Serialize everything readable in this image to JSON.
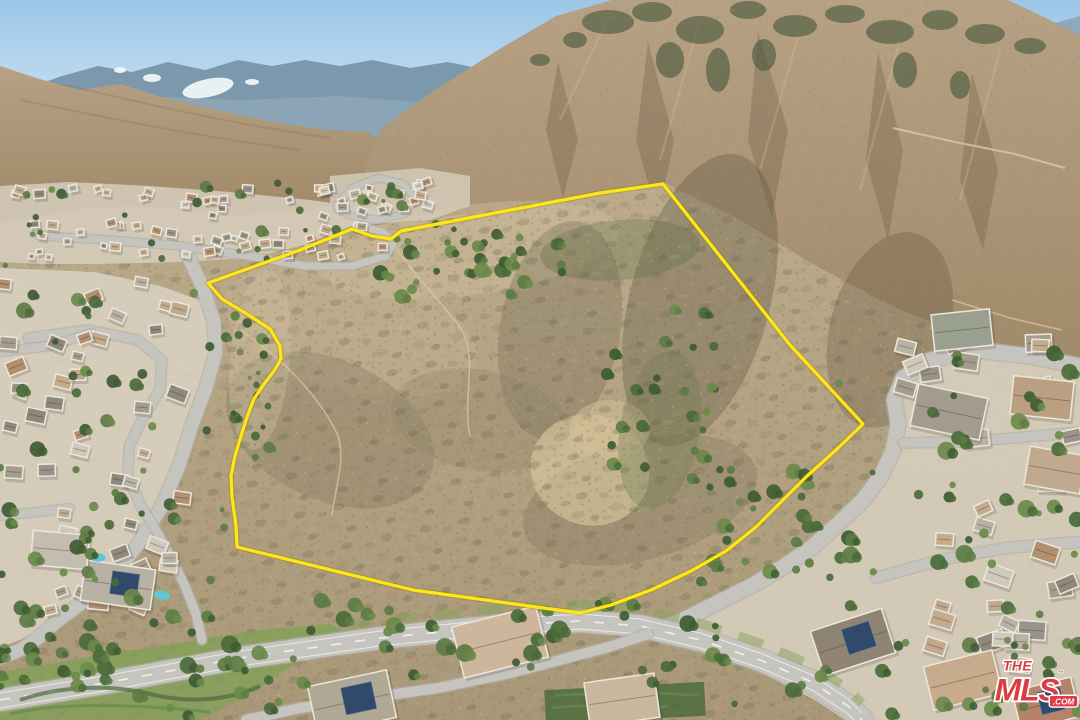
{
  "image": {
    "width": 1080,
    "height": 720,
    "kind": "aerial-drone-photo",
    "description": "Aerial real-estate photo of a vacant hillside land parcel outlined in yellow, surrounded by suburban neighborhoods at the foot of large scrub-covered mountains under a blue sky"
  },
  "watermark": {
    "line1": "THE",
    "line2": "MLS",
    "tm": "™",
    "suffix": ".COM",
    "red": "#dc3b41",
    "white": "#ffffff"
  },
  "palette": {
    "sky_top": "#9cc6e8",
    "sky_bottom": "#ddeef8",
    "far_ridge": "#7b98ad",
    "far_ridge2": "#91a9b8",
    "snow": "#f2f7fa",
    "mtn_light": "#b7a184",
    "mtn_dark": "#9e8867",
    "canyon": "#6e5a44",
    "forest": "#44573a",
    "streak": "#cfbd9b",
    "fg_light": "#bcab8b",
    "fg_dark": "#a99878",
    "speck_dark": "#6f6750",
    "speck_light": "#d9cdad",
    "olive": "#8b8468",
    "pale_base": "#d6cebd",
    "nb_base": "#d8d0c0",
    "road": "#c6c4be",
    "road_casing": "#b0ada6",
    "dash": "#f2f2ee",
    "house_wall": "#ece7db",
    "solar_panel": "#31496b",
    "pool": "#5ec8d8",
    "lawn": "#7fa055",
    "hedge": "#4c6b3d",
    "trail": "#d8c9a8",
    "outline_yellow": "#ffe714",
    "outline_casing": "#8a7a00"
  },
  "parcel_outline": {
    "stroke_width": 3.2,
    "points": [
      [
        663,
        184
      ],
      [
        790,
        345
      ],
      [
        863,
        424
      ],
      [
        836,
        450
      ],
      [
        806,
        477
      ],
      [
        779,
        504
      ],
      [
        756,
        527
      ],
      [
        726,
        551
      ],
      [
        691,
        571
      ],
      [
        651,
        590
      ],
      [
        611,
        605
      ],
      [
        580,
        613
      ],
      [
        413,
        590
      ],
      [
        237,
        547
      ],
      [
        236,
        526
      ],
      [
        232,
        497
      ],
      [
        231,
        476
      ],
      [
        235,
        456
      ],
      [
        241,
        436
      ],
      [
        247,
        417
      ],
      [
        254,
        399
      ],
      [
        264,
        384
      ],
      [
        274,
        371
      ],
      [
        281,
        359
      ],
      [
        280,
        346
      ],
      [
        270,
        329
      ],
      [
        247,
        314
      ],
      [
        222,
        299
      ],
      [
        208,
        283
      ],
      [
        300,
        250
      ],
      [
        352,
        229
      ],
      [
        372,
        236
      ],
      [
        391,
        239
      ],
      [
        401,
        231
      ],
      [
        500,
        212
      ],
      [
        600,
        193
      ]
    ]
  },
  "roads": [
    {
      "name": "left-canyon-road",
      "width": 13,
      "points": [
        [
          187,
          254
        ],
        [
          203,
          288
        ],
        [
          214,
          322
        ],
        [
          216,
          352
        ],
        [
          206,
          388
        ],
        [
          193,
          422
        ],
        [
          179,
          466
        ],
        [
          161,
          508
        ],
        [
          137,
          546
        ],
        [
          111,
          578
        ],
        [
          83,
          602
        ],
        [
          56,
          622
        ],
        [
          38,
          638
        ],
        [
          20,
          650
        ],
        [
          0,
          658
        ]
      ]
    },
    {
      "name": "left-inner-street",
      "width": 9,
      "points": [
        [
          28,
          338
        ],
        [
          88,
          330
        ],
        [
          138,
          340
        ],
        [
          162,
          360
        ],
        [
          160,
          390
        ],
        [
          143,
          418
        ],
        [
          129,
          446
        ],
        [
          128,
          476
        ],
        [
          141,
          506
        ],
        [
          157,
          532
        ],
        [
          171,
          558
        ],
        [
          185,
          586
        ],
        [
          196,
          614
        ],
        [
          202,
          640
        ]
      ]
    },
    {
      "name": "left-connector-upper",
      "width": 8,
      "points": [
        [
          0,
          352
        ],
        [
          50,
          346
        ],
        [
          92,
          333
        ]
      ]
    },
    {
      "name": "left-connector-lower",
      "width": 8,
      "points": [
        [
          0,
          516
        ],
        [
          38,
          512
        ],
        [
          70,
          508
        ]
      ]
    },
    {
      "name": "upper-valley-road",
      "width": 7,
      "points": [
        [
          40,
          236
        ],
        [
          110,
          240
        ],
        [
          180,
          246
        ],
        [
          248,
          256
        ],
        [
          305,
          266
        ],
        [
          352,
          266
        ],
        [
          386,
          256
        ],
        [
          394,
          242
        ],
        [
          382,
          232
        ],
        [
          362,
          226
        ]
      ]
    },
    {
      "name": "upper-loop-road",
      "width": 6,
      "points": [
        [
          336,
          206
        ],
        [
          352,
          188
        ],
        [
          378,
          178
        ],
        [
          404,
          184
        ],
        [
          416,
          200
        ],
        [
          404,
          214
        ],
        [
          378,
          220
        ],
        [
          352,
          216
        ],
        [
          338,
          210
        ],
        [
          336,
          206
        ]
      ]
    },
    {
      "name": "right-canyon-road",
      "width": 15,
      "points": [
        [
          1080,
          366
        ],
        [
          1030,
          356
        ],
        [
          976,
          350
        ],
        [
          930,
          360
        ],
        [
          903,
          378
        ],
        [
          894,
          400
        ],
        [
          898,
          424
        ],
        [
          893,
          450
        ],
        [
          881,
          476
        ],
        [
          863,
          500
        ],
        [
          839,
          523
        ],
        [
          811,
          548
        ],
        [
          783,
          567
        ],
        [
          753,
          585
        ],
        [
          719,
          602
        ],
        [
          683,
          620
        ],
        [
          658,
          630
        ]
      ]
    },
    {
      "name": "right-side-street",
      "width": 9,
      "points": [
        [
          903,
          443
        ],
        [
          958,
          442
        ],
        [
          1014,
          438
        ],
        [
          1080,
          432
        ]
      ]
    },
    {
      "name": "right-lower-street",
      "width": 10,
      "points": [
        [
          876,
          578
        ],
        [
          940,
          560
        ],
        [
          1005,
          548
        ],
        [
          1080,
          542
        ]
      ]
    },
    {
      "name": "boulevard",
      "width": 22,
      "dashed": true,
      "points": [
        [
          0,
          700
        ],
        [
          110,
          682
        ],
        [
          240,
          658
        ],
        [
          380,
          638
        ],
        [
          500,
          626
        ],
        [
          580,
          621
        ],
        [
          640,
          626
        ],
        [
          700,
          640
        ],
        [
          760,
          660
        ],
        [
          812,
          682
        ],
        [
          848,
          706
        ],
        [
          862,
          720
        ]
      ]
    },
    {
      "name": "bottom-street",
      "width": 10,
      "points": [
        [
          246,
          720
        ],
        [
          300,
          708
        ],
        [
          368,
          698
        ],
        [
          438,
          688
        ],
        [
          506,
          674
        ],
        [
          560,
          660
        ],
        [
          612,
          646
        ],
        [
          648,
          634
        ]
      ]
    }
  ],
  "roof_colors": [
    "#b8b2a5",
    "#a49d8f",
    "#c3ab8b",
    "#b28f6f",
    "#99948a",
    "#cfc9bb",
    "#8e897c",
    "#c0a98f"
  ],
  "tree_colors": [
    "#4a6b3a",
    "#5d7c44",
    "#3e5c33",
    "#6b8a4a"
  ],
  "house_regions": [
    {
      "name": "upper-valley",
      "x": 8,
      "y": 188,
      "w": 380,
      "h": 70,
      "count": 64,
      "min": 7,
      "max": 13,
      "angle": 20
    },
    {
      "name": "upper-valley-east",
      "x": 335,
      "y": 172,
      "w": 120,
      "h": 46,
      "count": 16,
      "min": 7,
      "max": 12,
      "angle": 20
    },
    {
      "name": "left-neighborhood",
      "x": 2,
      "y": 282,
      "w": 190,
      "h": 330,
      "count": 46,
      "min": 12,
      "max": 22,
      "angle": 25
    },
    {
      "name": "right-neighborhood",
      "x": 895,
      "y": 340,
      "w": 180,
      "h": 300,
      "count": 24,
      "min": 16,
      "max": 28,
      "angle": 25
    },
    {
      "name": "bottom-right-neighborhood",
      "x": 860,
      "y": 600,
      "w": 210,
      "h": 112,
      "count": 8,
      "min": 20,
      "max": 30,
      "angle": 20
    }
  ],
  "featured_houses": [
    {
      "x": 500,
      "y": 642,
      "w": 88,
      "h": 54,
      "a": -14,
      "roof": "#cdb69b",
      "solar": false,
      "pool": false
    },
    {
      "x": 352,
      "y": 702,
      "w": 82,
      "h": 50,
      "a": -12,
      "roof": "#b0a794",
      "solar": true,
      "pool": false
    },
    {
      "x": 622,
      "y": 700,
      "w": 72,
      "h": 46,
      "a": -8,
      "roof": "#c9b79d",
      "solar": false,
      "pool": false
    },
    {
      "x": 853,
      "y": 642,
      "w": 76,
      "h": 48,
      "a": -18,
      "roof": "#8f8373",
      "solar": true,
      "pool": false
    },
    {
      "x": 963,
      "y": 680,
      "w": 72,
      "h": 46,
      "a": -14,
      "roof": "#c8aa8d",
      "solar": false,
      "pool": false
    },
    {
      "x": 1046,
      "y": 704,
      "w": 62,
      "h": 42,
      "a": -14,
      "roof": "#b5826a",
      "solar": true,
      "pool": false
    },
    {
      "x": 949,
      "y": 412,
      "w": 72,
      "h": 44,
      "a": 12,
      "roof": "#a39b8d",
      "solar": false,
      "pool": false
    },
    {
      "x": 1042,
      "y": 398,
      "w": 62,
      "h": 40,
      "a": 6,
      "roof": "#ba9f82",
      "solar": false,
      "pool": false
    },
    {
      "x": 962,
      "y": 330,
      "w": 60,
      "h": 38,
      "a": -6,
      "roof": "#9aa08f",
      "solar": false,
      "pool": false
    },
    {
      "x": 1055,
      "y": 470,
      "w": 58,
      "h": 40,
      "a": 10,
      "roof": "#c0a98f",
      "solar": false,
      "pool": false
    },
    {
      "x": 118,
      "y": 585,
      "w": 72,
      "h": 42,
      "a": 8,
      "roof": "#b7b1a3",
      "solar": true,
      "pool": true
    },
    {
      "x": 60,
      "y": 550,
      "w": 58,
      "h": 36,
      "a": 5,
      "roof": "#c4bdaf",
      "solar": false,
      "pool": true
    }
  ],
  "tree_regions": [
    {
      "name": "upper-drainage",
      "x": 380,
      "y": 234,
      "w": 190,
      "h": 66,
      "count": 30,
      "min": 3,
      "max": 8
    },
    {
      "name": "parcel-east-drainage",
      "x": 596,
      "y": 300,
      "w": 120,
      "h": 170,
      "count": 24,
      "min": 3,
      "max": 7
    },
    {
      "name": "boundary-greenbelt",
      "x": 690,
      "y": 468,
      "w": 190,
      "h": 120,
      "count": 30,
      "min": 3,
      "max": 8
    },
    {
      "name": "boulevard-trees",
      "x": 0,
      "y": 596,
      "w": 720,
      "h": 95,
      "count": 48,
      "min": 3,
      "max": 9
    },
    {
      "name": "left-neighborhood-trees",
      "x": 0,
      "y": 286,
      "w": 215,
      "h": 340,
      "count": 48,
      "min": 3,
      "max": 8
    },
    {
      "name": "right-neighborhood-trees",
      "x": 835,
      "y": 352,
      "w": 245,
      "h": 340,
      "count": 42,
      "min": 3,
      "max": 9
    },
    {
      "name": "upper-valley-trees",
      "x": 0,
      "y": 182,
      "w": 460,
      "h": 84,
      "count": 34,
      "min": 2,
      "max": 6
    },
    {
      "name": "bottom-left-slope-trees",
      "x": 0,
      "y": 628,
      "w": 320,
      "h": 90,
      "count": 30,
      "min": 3,
      "max": 8
    },
    {
      "name": "bottom-right-trees",
      "x": 690,
      "y": 640,
      "w": 390,
      "h": 78,
      "count": 26,
      "min": 3,
      "max": 8
    },
    {
      "name": "west-road-strip-trees",
      "x": 222,
      "y": 300,
      "w": 48,
      "h": 250,
      "count": 20,
      "min": 2,
      "max": 6
    }
  ]
}
